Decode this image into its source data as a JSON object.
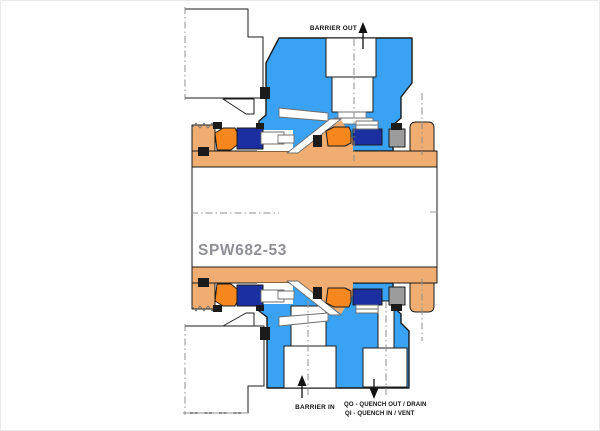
{
  "diagram": {
    "part_number": "SPW682-53",
    "labels": {
      "barrier_out": "BARRIER OUT",
      "barrier_in": "BARRIER IN",
      "quench_line1": "QO - QUENCH OUT / DRAIN",
      "quench_line2": "QI - QUENCH IN / VENT"
    },
    "colors": {
      "housing_blue": "#3AA2F2",
      "seal_ring_navy": "#1B2FA0",
      "component_orange": "#F6871E",
      "sleeve_tan": "#EFAD72",
      "metal_gray": "#9C9C9C",
      "outline_black": "#1B1B1B",
      "part_number_gray": "#8F9096"
    }
  }
}
